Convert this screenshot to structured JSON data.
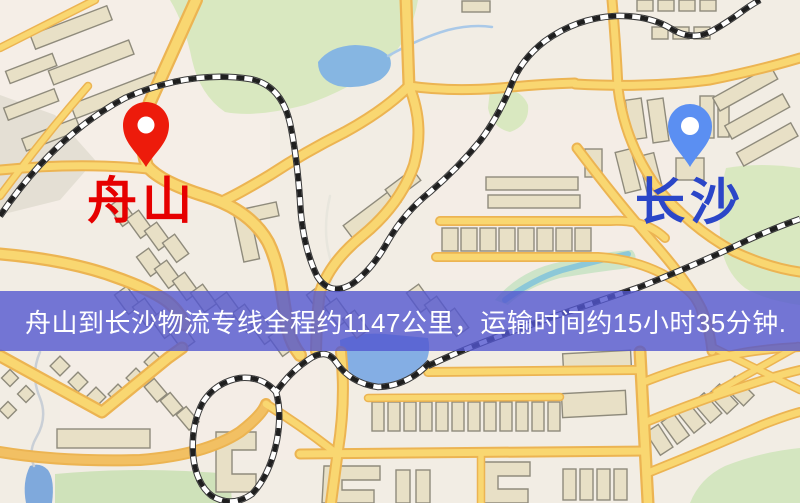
{
  "map": {
    "origin": {
      "label": "舟山",
      "label_color": "#e60000",
      "pin_color": "#ed1b0b"
    },
    "destination": {
      "label": "长沙",
      "label_color": "#2b46c8",
      "pin_color": "#5b8ff2"
    }
  },
  "banner": {
    "text": "舟山到长沙物流专线全程约1147公里，运输时间约15小时35分钟.",
    "background_color": "#5256cf",
    "background_rgba": "rgba(82,86,207,0.80)",
    "text_color": "#ffffff",
    "route_from": "舟山",
    "route_to": "长沙",
    "distance_text": "约1147公里",
    "duration_text": "约15小时35分钟"
  },
  "map_colors": {
    "background": "#f2ede4",
    "road_fill": "#f9d771",
    "road_casing": "#ecb452",
    "water": "#86b6e2",
    "park": "#d9e8c0",
    "building": "#e8e0c6",
    "railway": "#1f1f1f"
  }
}
